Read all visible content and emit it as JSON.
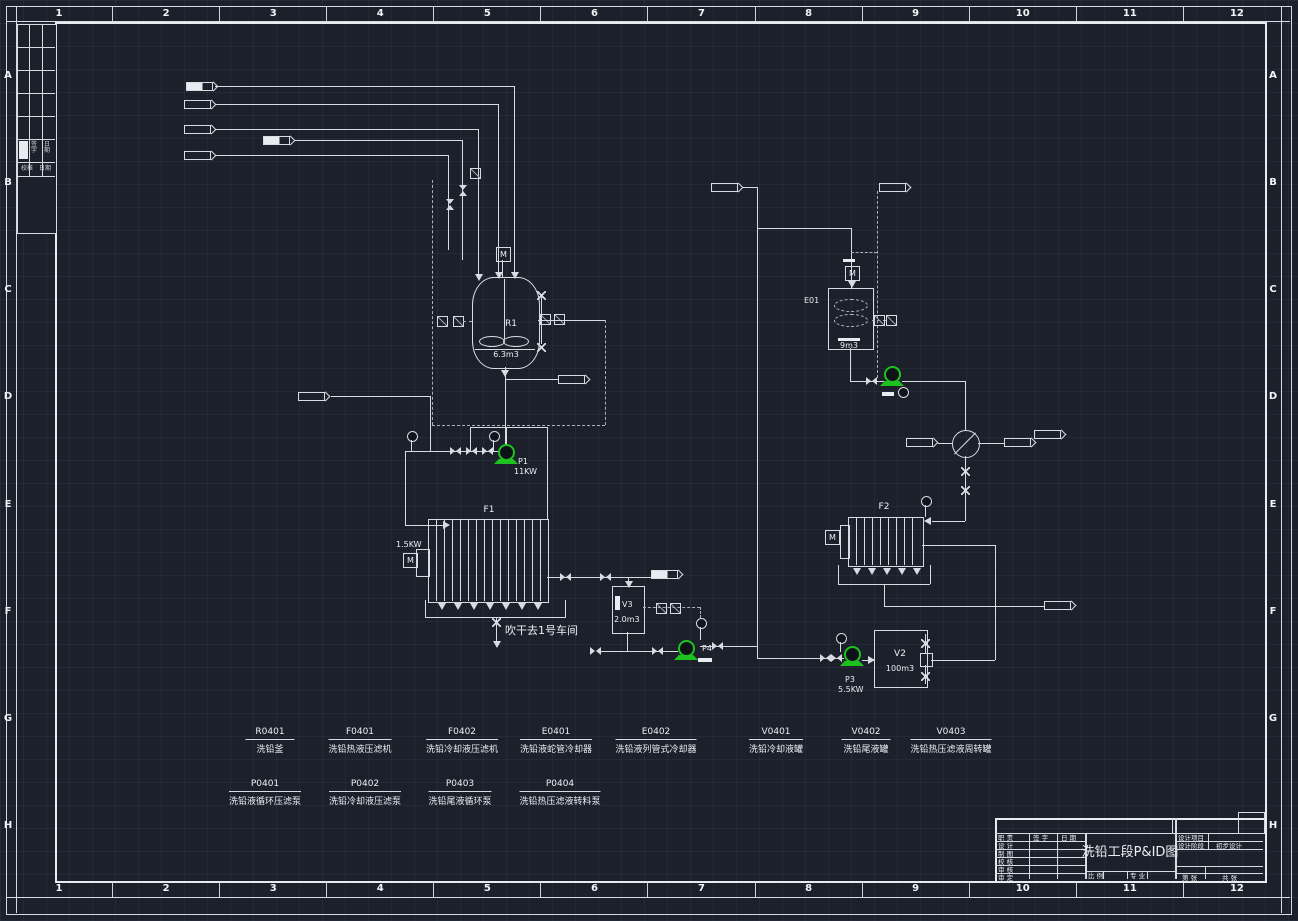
{
  "frame": {
    "columns": [
      "1",
      "2",
      "3",
      "4",
      "5",
      "6",
      "7",
      "8",
      "9",
      "10",
      "11",
      "12"
    ],
    "rows": [
      "A",
      "B",
      "C",
      "D",
      "E",
      "F",
      "G",
      "H"
    ]
  },
  "revision_table": {
    "sign": "签字",
    "date": "日期",
    "check": "校核",
    "date2": "日期"
  },
  "title_block": {
    "title": "洗铅工段P&ID图",
    "resp_label": "职 责",
    "sign_label": "签 字",
    "date_label": "日 期",
    "roles": [
      "设 计",
      "制 图",
      "校 核",
      "审 核",
      "审 定"
    ],
    "project_label": "设计项目",
    "stage_label": "设计阶段",
    "stage_value": "初步设计",
    "scale_label": "比 例",
    "discipline_label": "专 业",
    "sheet_label": "第  张",
    "total_label": "共  张"
  },
  "equipment_list": {
    "row1": [
      {
        "code": "R0401",
        "name": "洗铅釜"
      },
      {
        "code": "F0401",
        "name": "洗铅热液压滤机"
      },
      {
        "code": "F0402",
        "name": "洗铅冷却液压滤机"
      },
      {
        "code": "E0401",
        "name": "洗铅液蛇管冷却器"
      },
      {
        "code": "E0402",
        "name": "洗铅液列管式冷却器"
      },
      {
        "code": "V0401",
        "name": "洗铅冷却液罐"
      },
      {
        "code": "V0402",
        "name": "洗铅尾液罐"
      },
      {
        "code": "V0403",
        "name": "洗铅热压滤液周转罐"
      }
    ],
    "row2": [
      {
        "code": "P0401",
        "name": "洗铅液循环压滤泵"
      },
      {
        "code": "P0402",
        "name": "洗铅冷却液压滤泵"
      },
      {
        "code": "P0403",
        "name": "洗铅尾液循环泵"
      },
      {
        "code": "P0404",
        "name": "洗铅热压滤液转料泵"
      }
    ]
  },
  "diagram": {
    "reactor_tag": "R1",
    "reactor_volume": "6.3m3",
    "condenser_tag": "E01",
    "condenser_volume": "9m3",
    "filter1_tag": "F1",
    "filter1_power": "1.5KW",
    "filter2_tag": "F2",
    "pump1_tag": "P1",
    "pump1_power": "11KW",
    "pump3_tag": "P3",
    "pump3_power": "5.5KW",
    "pump4_tag": "P4",
    "tank2_tag": "V2",
    "tank2_volume": "100m3",
    "tank3_tag": "V3",
    "tank3_volume": "2.0m3",
    "note": "吹干去1号车间",
    "motor": "M"
  }
}
